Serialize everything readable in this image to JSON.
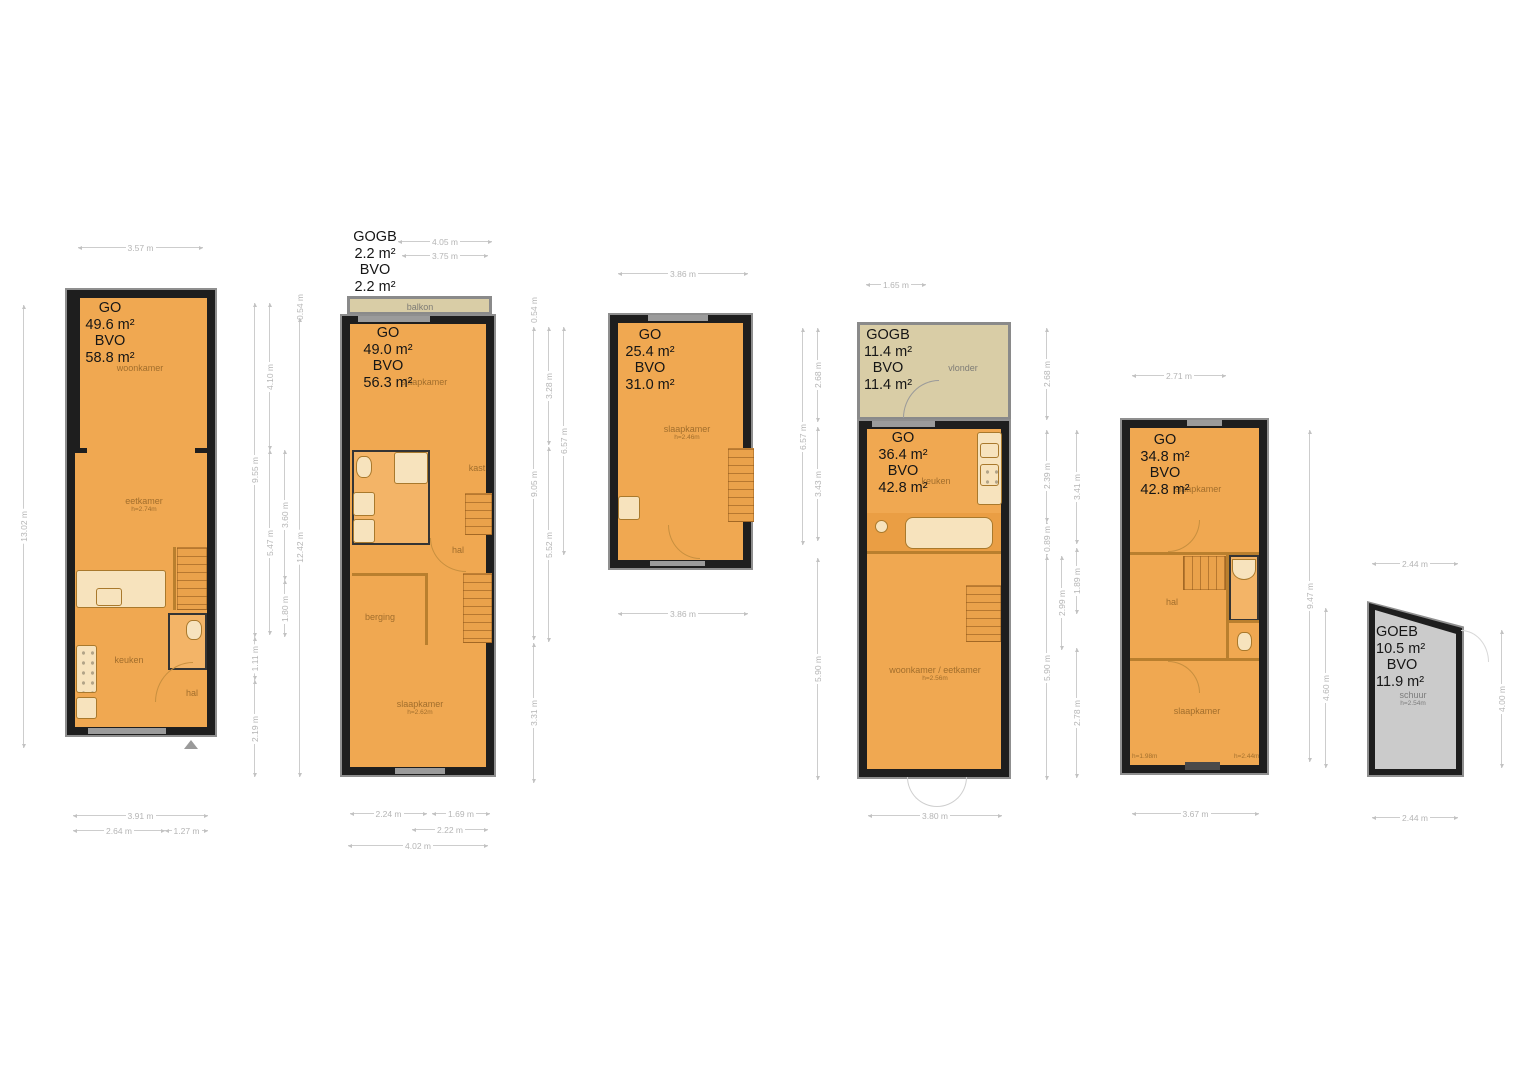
{
  "colors": {
    "floor": "#f0a851",
    "floor_light": "#f3b467",
    "wall": "#1e1e1e",
    "wall_frame": "#8f8f8f",
    "balcony_fill": "#d9cda6",
    "shed_fill": "#cbcbcb",
    "dimension": "#b5b5b5",
    "room_label": "#82581e"
  },
  "plans": [
    {
      "id": "floorplan-1",
      "area_label": [
        "GO",
        "49.6 m²",
        "BVO",
        "58.8 m²"
      ],
      "rooms": [
        {
          "label": "woonkamer",
          "sub": ""
        },
        {
          "label": "eetkamer",
          "sub": "h=2.74m"
        },
        {
          "label": "keuken",
          "sub": ""
        },
        {
          "label": "hal",
          "sub": ""
        }
      ],
      "dims": [
        "3.57 m",
        "13.02 m",
        "9.55 m",
        "1.11 m",
        "2.19 m",
        "4.10 m",
        "5.47 m",
        "3.60 m",
        "1.80 m",
        "0.54 m",
        "12.42 m",
        "3.91 m",
        "2.64 m",
        "1.27 m"
      ]
    },
    {
      "id": "floorplan-2",
      "balcony_label": [
        "GOGB",
        "2.2 m²",
        "BVO",
        "2.2 m²"
      ],
      "area_label": [
        "GO",
        "49.0 m²",
        "BVO",
        "56.3 m²"
      ],
      "rooms": [
        {
          "label": "balkon",
          "sub": ""
        },
        {
          "label": "slaapkamer",
          "sub": ""
        },
        {
          "label": "kast",
          "sub": ""
        },
        {
          "label": "hal",
          "sub": ""
        },
        {
          "label": "berging",
          "sub": ""
        },
        {
          "label": "slaapkamer",
          "sub": "h=2.62m"
        }
      ],
      "dims": [
        "4.05 m",
        "3.75 m",
        "2.24 m",
        "1.69 m",
        "2.22 m",
        "4.02 m"
      ]
    },
    {
      "id": "floorplan-3",
      "area_label": [
        "GO",
        "25.4 m²",
        "BVO",
        "31.0 m²"
      ],
      "rooms": [
        {
          "label": "slaapkamer",
          "sub": "h=2.46m"
        }
      ],
      "dims": [
        "3.86 m",
        "0.54 m",
        "9.05 m",
        "3.31 m",
        "3.28 m",
        "5.52 m",
        "6.57 m",
        "3.86 m",
        "6.57 m",
        "2.68 m",
        "3.43 m",
        "5.90 m"
      ]
    },
    {
      "id": "floorplan-4",
      "balcony_label": [
        "GOGB",
        "11.4 m²",
        "BVO",
        "11.4 m²"
      ],
      "area_label": [
        "GO",
        "36.4 m²",
        "BVO",
        "42.8 m²"
      ],
      "rooms": [
        {
          "label": "vlonder",
          "sub": ""
        },
        {
          "label": "keuken",
          "sub": ""
        },
        {
          "label": "woonkamer / eetkamer",
          "sub": "h=2.56m"
        }
      ],
      "dims": [
        "1.65 m",
        "2.68 m",
        "2.39 m",
        "0.89 m",
        "5.90 m",
        "3.80 m"
      ]
    },
    {
      "id": "floorplan-5",
      "area_label": [
        "GO",
        "34.8 m²",
        "BVO",
        "42.8 m²"
      ],
      "rooms": [
        {
          "label": "slaapkamer",
          "sub": ""
        },
        {
          "label": "hal",
          "sub": ""
        },
        {
          "label": "slaapkamer",
          "sub": ""
        },
        {
          "label": "h=1.98m",
          "sub": ""
        },
        {
          "label": "h=2.44m",
          "sub": ""
        }
      ],
      "dims": [
        "2.71 m",
        "2.99 m",
        "3.41 m",
        "1.89 m",
        "2.78 m",
        "9.47 m",
        "3.67 m"
      ]
    },
    {
      "id": "shed",
      "area_label": [
        "GOEB",
        "10.5 m²",
        "BVO",
        "11.9 m²"
      ],
      "rooms": [
        {
          "label": "schuur",
          "sub": "h=2.54m"
        }
      ],
      "dims": [
        "2.44 m",
        "4.60 m",
        "4.00 m",
        "2.44 m"
      ]
    }
  ]
}
